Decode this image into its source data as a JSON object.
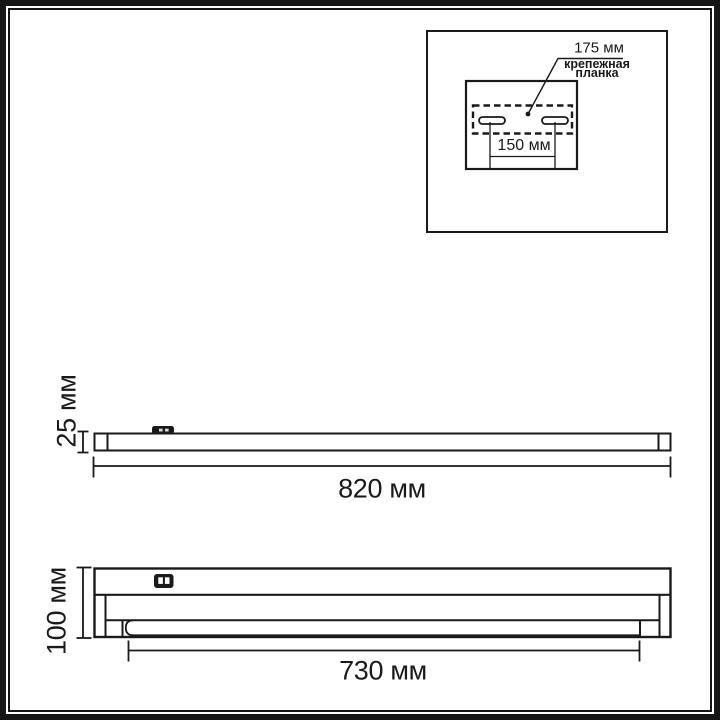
{
  "diagram": {
    "title_hint": "linear luminaire dimensional drawing",
    "line_color": "#1a1a1a",
    "background_color": "#ffffff",
    "inset": {
      "plate_length_label": "175 мм",
      "plate_name_line1": "крепежная",
      "plate_name_line2": "планка",
      "hole_spacing_label": "150 мм"
    },
    "side_view": {
      "height_label": "25 мм",
      "length_label": "820 мм"
    },
    "front_view": {
      "height_label": "100 мм",
      "tube_length_label": "730 мм"
    },
    "icons": [
      {
        "name": "power-switch-icon",
        "meaning": "switch block on luminaire body"
      },
      {
        "name": "mounting-slot-icon",
        "meaning": "keyhole mounting slots on plate"
      }
    ]
  }
}
